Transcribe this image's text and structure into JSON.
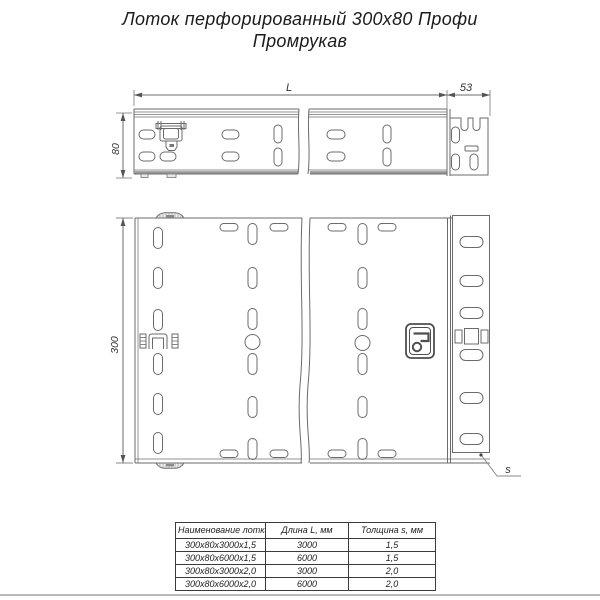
{
  "title": {
    "line1": "Лоток перфорированный 300х80 Профи",
    "line2": "Промрукав"
  },
  "drawing": {
    "side_view": {
      "dim_length_label": "L",
      "dim_end_label": "53",
      "dim_height_label": "80"
    },
    "plan_view": {
      "dim_width_label": "300",
      "dim_thickness_label": "s"
    },
    "logo_name": "promrukav-logo"
  },
  "colors": {
    "line": "#6b6b6b",
    "dark_line": "#3a3a3a",
    "thick_edge": "#9a9a9a",
    "text": "#222222",
    "background": "#ffffff"
  },
  "table": {
    "headers": [
      "Наименование лотка",
      "Длина L, мм",
      "Толщина s, мм"
    ],
    "rows": [
      [
        "300х80х3000х1,5",
        "3000",
        "1,5"
      ],
      [
        "300х80х6000х1,5",
        "6000",
        "1,5"
      ],
      [
        "300х80х3000х2,0",
        "3000",
        "2,0"
      ],
      [
        "300х80х6000х2,0",
        "6000",
        "2,0"
      ]
    ]
  }
}
